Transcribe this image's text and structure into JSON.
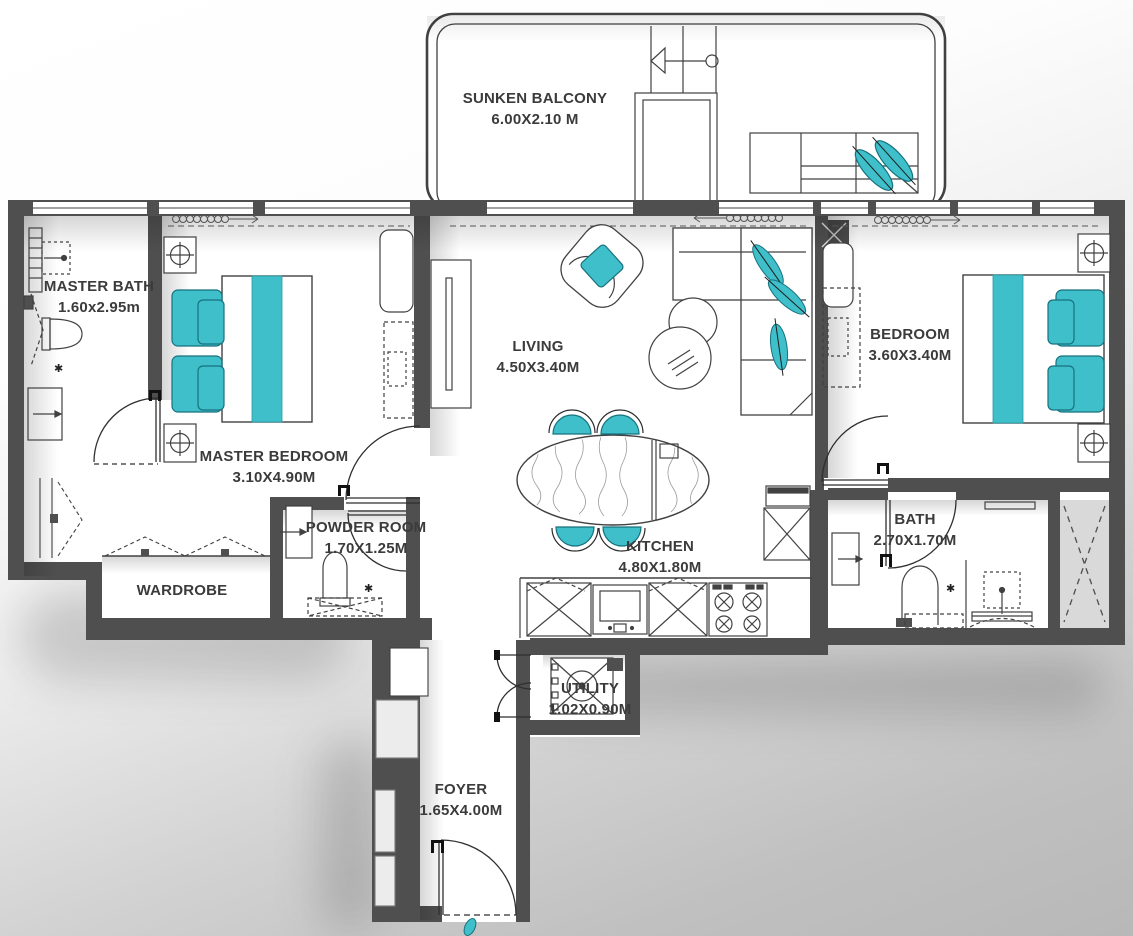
{
  "title": "2 Bedroom Apartment Floor Plan",
  "palette": {
    "wall": "#4f4f4f",
    "line": "#414141",
    "accent_teal": "#3fbfca",
    "accent_teal_dark": "#17727e",
    "label_text": "#3b3b3b",
    "floor": "#ffffff",
    "background": "#b8b8b8"
  },
  "rooms": [
    {
      "id": "sunken-balcony",
      "name": "SUNKEN BALCONY",
      "dims": "6.00X2.10 M"
    },
    {
      "id": "master-bath",
      "name": "MASTER BATH",
      "dims": "1.60x2.95m"
    },
    {
      "id": "master-bedroom",
      "name": "MASTER BEDROOM",
      "dims": "3.10X4.90M"
    },
    {
      "id": "living",
      "name": "LIVING",
      "dims": "4.50X3.40M"
    },
    {
      "id": "bedroom",
      "name": "BEDROOM",
      "dims": "3.60X3.40M"
    },
    {
      "id": "powder-room",
      "name": "POWDER ROOM",
      "dims": "1.70X1.25M"
    },
    {
      "id": "wardrobe",
      "name": "WARDROBE",
      "dims": ""
    },
    {
      "id": "kitchen",
      "name": "KITCHEN",
      "dims": "4.80X1.80M"
    },
    {
      "id": "bath",
      "name": "BATH",
      "dims": "2.70X1.70M"
    },
    {
      "id": "utility",
      "name": "UTILITY",
      "dims": "1.02X0.90M"
    },
    {
      "id": "foyer",
      "name": "FOYER",
      "dims": "1.65X4.00M"
    }
  ],
  "icons": {
    "flower": "✱"
  }
}
